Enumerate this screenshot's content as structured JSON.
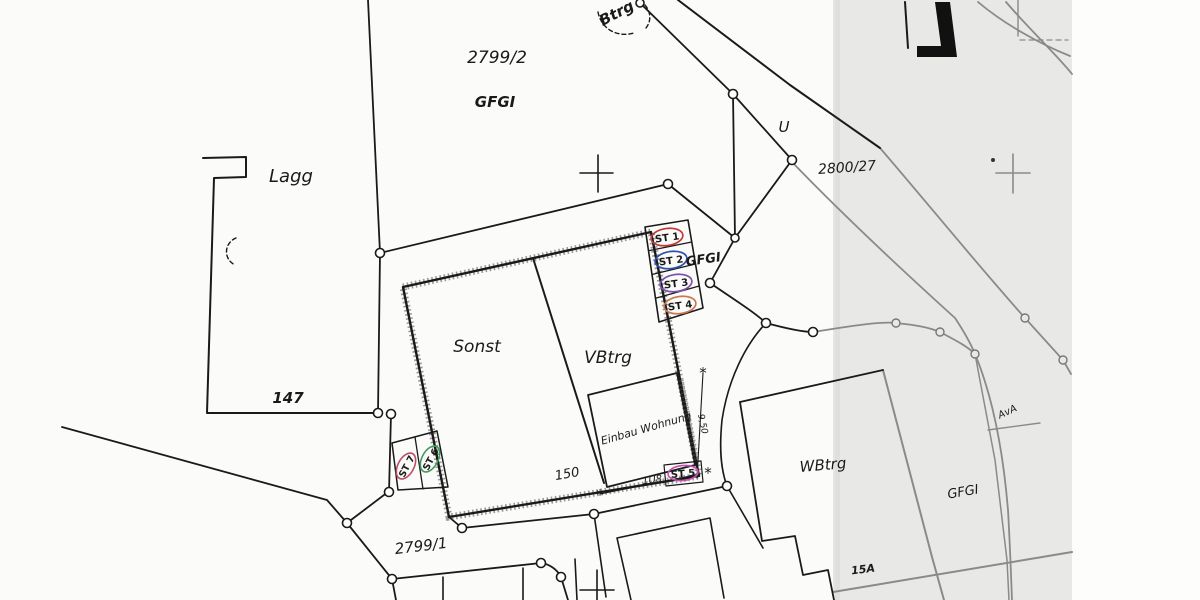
{
  "map": {
    "title": "cadastral-site-plan",
    "parcels": {
      "p2799_2": "2799/2",
      "p2799_1": "2799/1",
      "p2800_27": "2800/27",
      "p147": "147",
      "u": "U",
      "gfgi_top": "GFGI",
      "gfgi_right": "GFGI",
      "lagg": "Lagg"
    },
    "buildings": {
      "btrg_top": "Btrg",
      "sonst": "Sonst",
      "vbtrg": "VBtrg",
      "einbau": "Einbau Wohnung",
      "wbtrg_right": "WBtrg",
      "n15a": "15A",
      "ava": "AvA"
    },
    "dimensions": {
      "d150": "150",
      "d1u8": "1U8",
      "d950": "9,50",
      "asterisk": "*"
    },
    "stamps": [
      {
        "id": "st1",
        "label": "ST 1",
        "color": "#bf3a3a"
      },
      {
        "id": "st2",
        "label": "ST 2",
        "color": "#2f4fae"
      },
      {
        "id": "st3",
        "label": "ST 3",
        "color": "#7e4fae"
      },
      {
        "id": "st4",
        "label": "ST 4",
        "color": "#c97950"
      },
      {
        "id": "st5",
        "label": "ST 5",
        "color": "#c94fb0"
      },
      {
        "id": "st6",
        "label": "ST 6",
        "color": "#3f9e5a"
      },
      {
        "id": "st7",
        "label": "ST 7",
        "color": "#bf4f66"
      }
    ],
    "stamp_overlay": {
      "label": "GFGI"
    },
    "colors": {
      "ink": "#1a1a1a",
      "scan_shadow_band": "#e8e8e7",
      "paper": "#fbfbfa",
      "faint_line": "#8a8a8a"
    }
  }
}
